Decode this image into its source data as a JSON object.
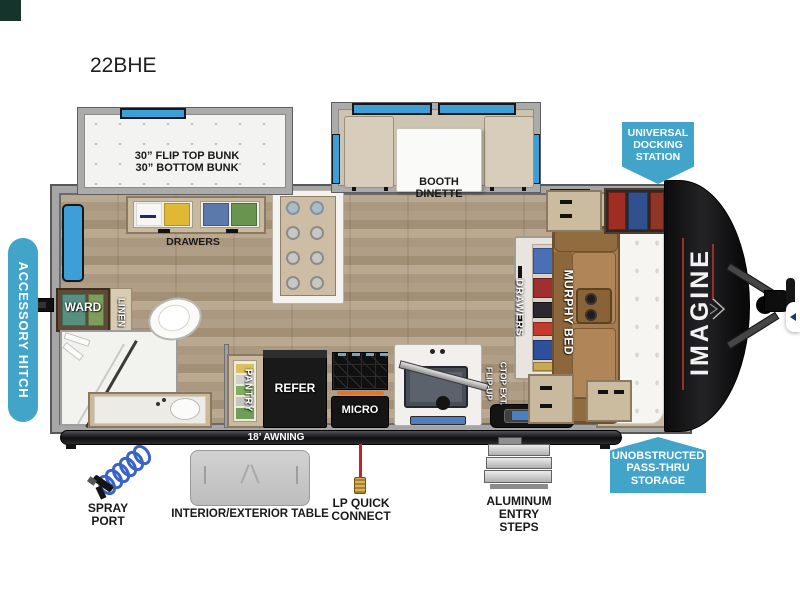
{
  "title": "22BHE",
  "colors": {
    "badge_teal": "#41a4c8",
    "accent_red": "#993128",
    "floor_wood": "#b3a18a",
    "awning_bar": "#141416"
  },
  "callouts": {
    "accessory_hitch": "ACCESSORY HITCH",
    "universal_docking_station": "UNIVERSAL\nDOCKING\nSTATION",
    "unobstructed_pass_thru_storage": "UNOBSTRUCTED\nPASS-THRU\nSTORAGE"
  },
  "floorplan_labels": {
    "bunk": "30” FLIP TOP BUNK\n30” BOTTOM BUNK",
    "bunk_drawers": "DRAWERS",
    "booth_dinette": "BOOTH\nDINETTE",
    "murphy_bed": "MURPHY BED",
    "murphy_drawers": "DRAWERS",
    "ward": "WARD",
    "linen": "LINEN",
    "pantry": "PANTRY",
    "refer": "REFER",
    "micro": "MICRO",
    "flip_up_line1": "FLIP-UP",
    "flip_up_line2": "CTOP EXT.",
    "brand_front_cap": "IMAGINE"
  },
  "exterior_features": {
    "awning": "18’ AWNING",
    "spray_port": "SPRAY\nPORT",
    "table": "INTERIOR/EXTERIOR TABLE",
    "lp_quick_connect": "LP QUICK\nCONNECT",
    "entry_steps": "ALUMINUM\nENTRY STEPS"
  }
}
